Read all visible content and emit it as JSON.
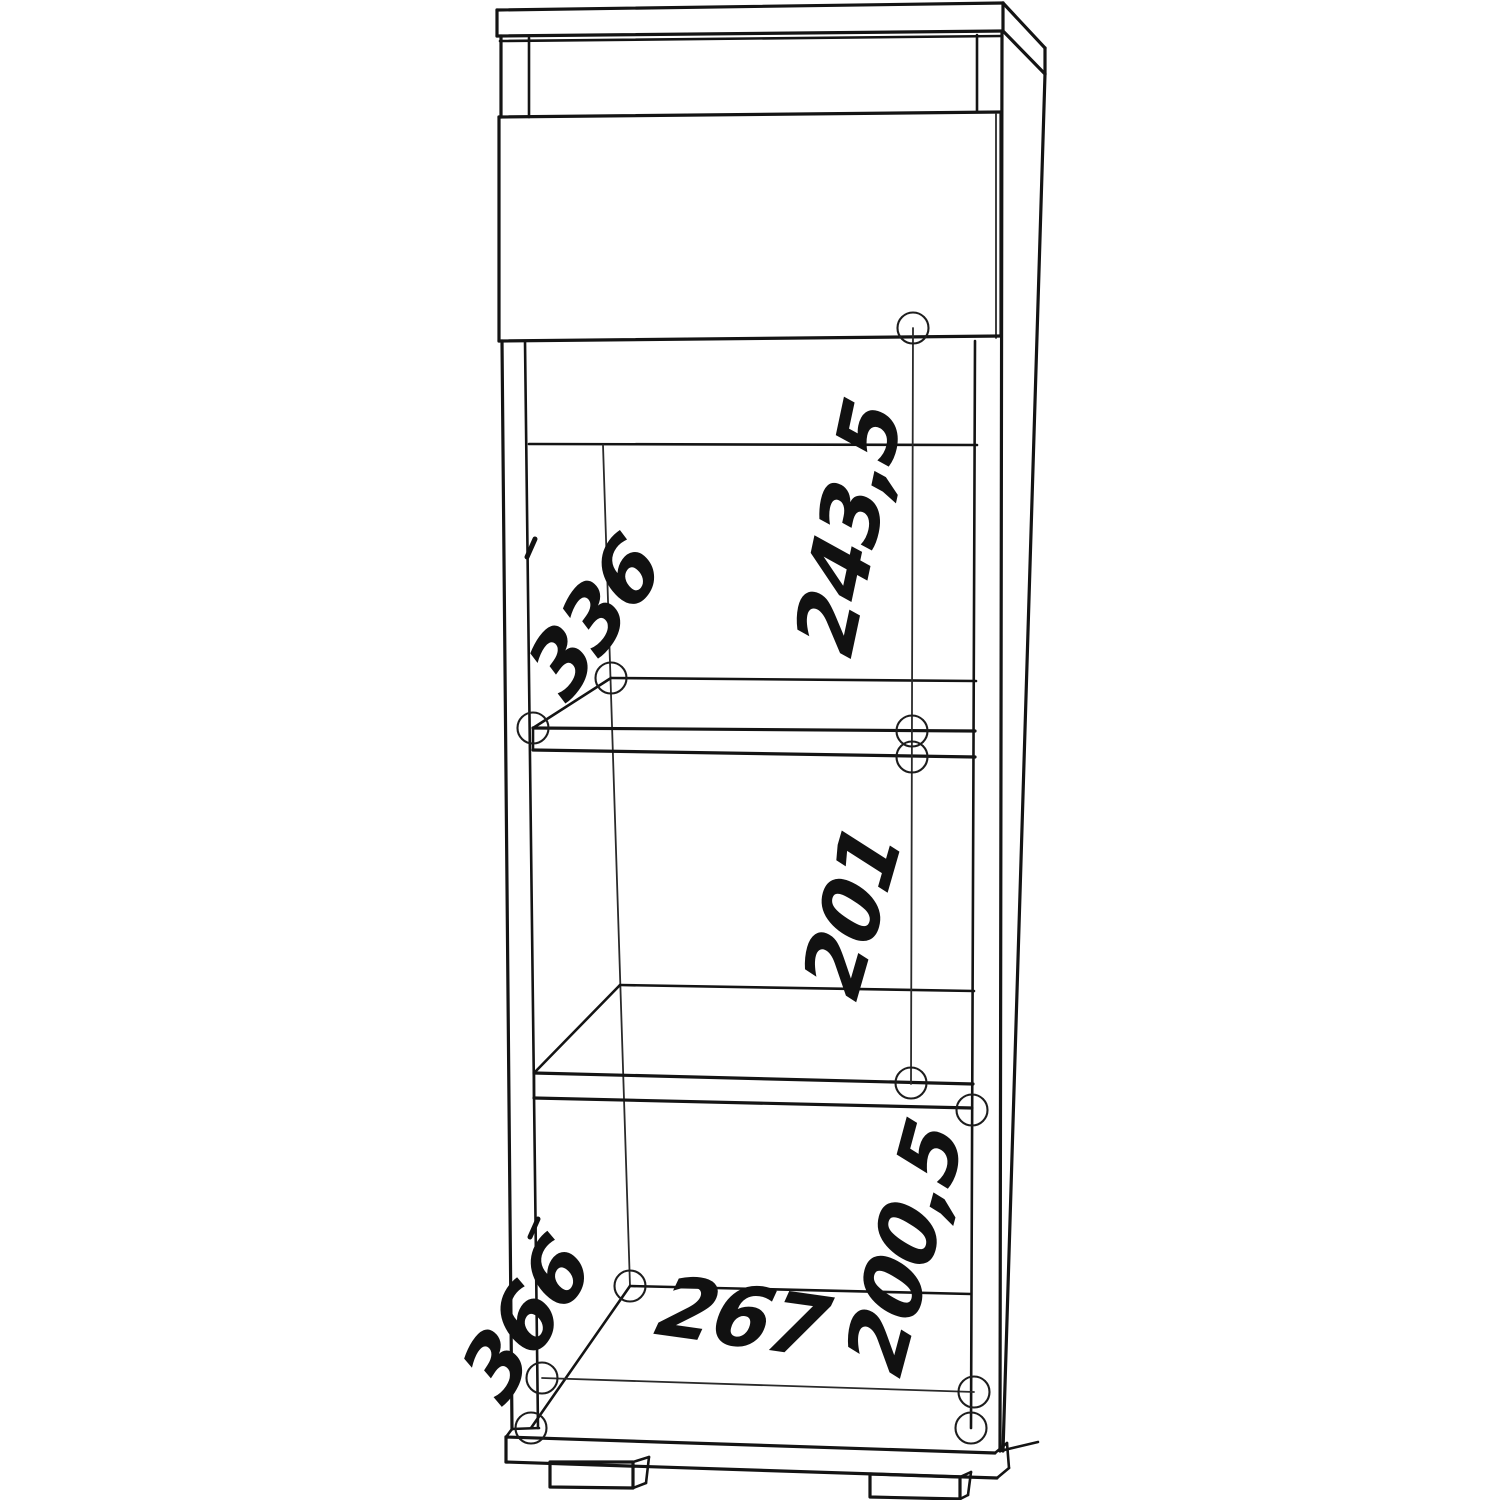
{
  "drawing": {
    "description": "Black-and-white technical line drawing of a tall narrow cabinet (top panel, drawer front, two shelves, bottom panel, plinth and two feet) shown in slight right-side perspective, with handwritten-style dimension annotations and small circular fastener markers",
    "background": "#ffffff",
    "line_color": "#141414",
    "annotation_color": "#111111",
    "dimensions": [
      {
        "id": "upper-opening-height",
        "value": "243,5"
      },
      {
        "id": "shelf-depth-top",
        "value": "336"
      },
      {
        "id": "middle-opening-height",
        "value": "201"
      },
      {
        "id": "lower-opening-height",
        "value": "200,5"
      },
      {
        "id": "bottom-opening-width",
        "value": "267"
      },
      {
        "id": "bottom-panel-depth",
        "value": "366"
      }
    ]
  }
}
